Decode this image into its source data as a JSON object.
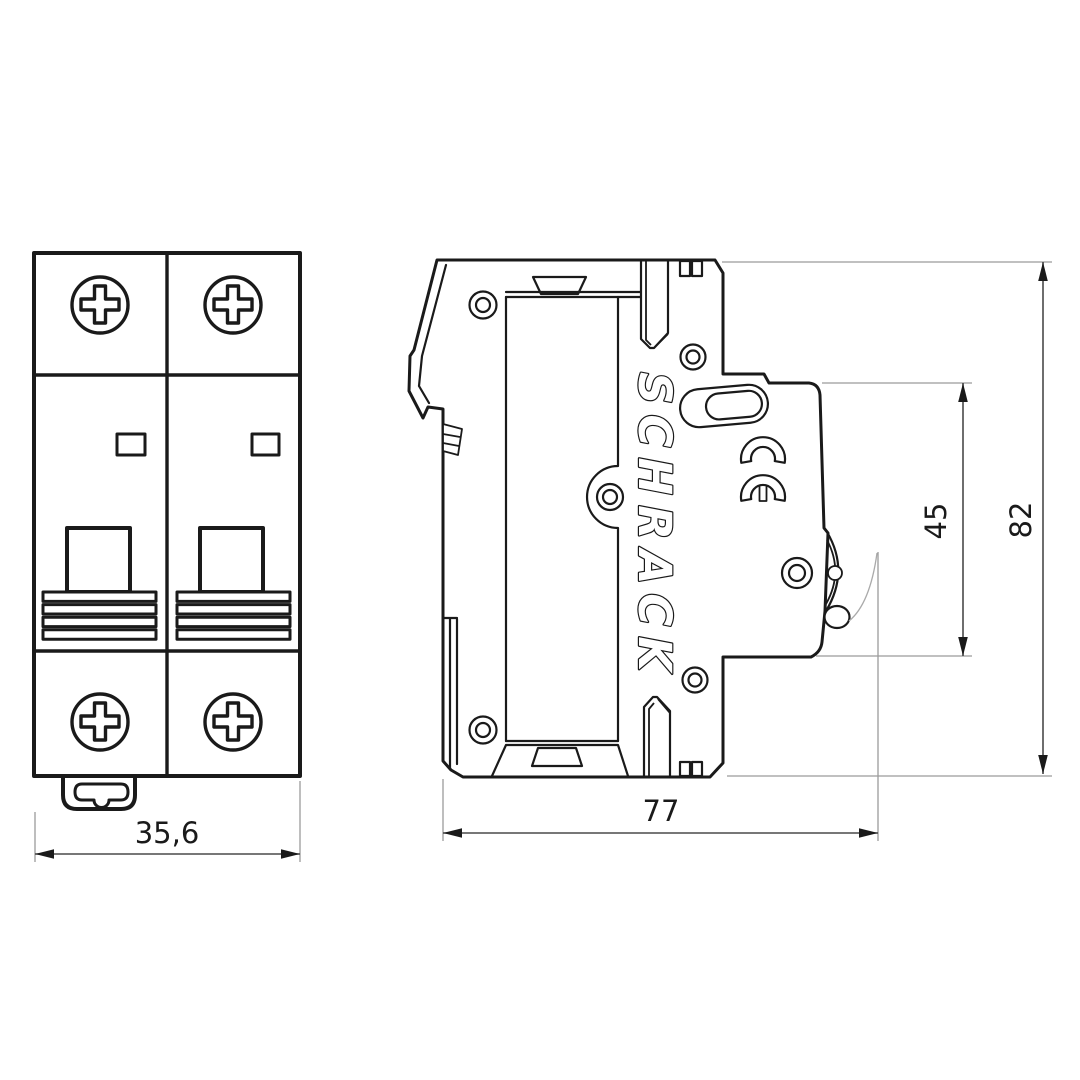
{
  "front_view": {
    "dimension_width": "35,6"
  },
  "side_view": {
    "brand": "SCHRACK",
    "ce_mark": "CE",
    "dimension_depth": "77",
    "dimension_handle_height": "45",
    "dimension_total_height": "82"
  },
  "colors": {
    "line": "#1a1a1a",
    "indicator_fill": "#c9c9cb",
    "extension_line": "#9b9b9b",
    "background": "#ffffff"
  }
}
